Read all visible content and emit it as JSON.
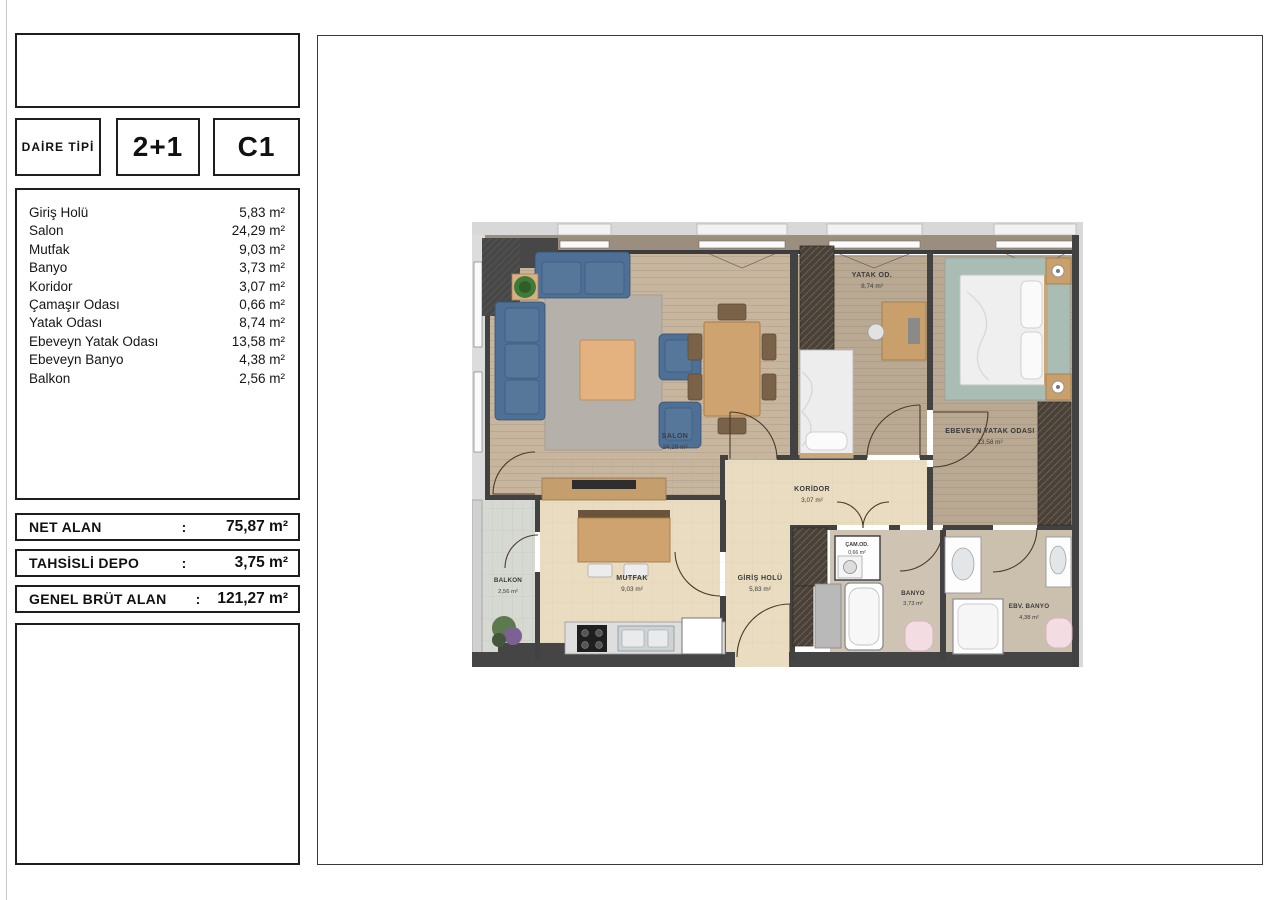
{
  "header": {
    "daire_tipi_label": "DAİRE TİPİ",
    "plan_type": "2+1",
    "unit_code": "C1"
  },
  "room_list": {
    "items": [
      {
        "name": "Giriş Holü",
        "area": "5,83 m²"
      },
      {
        "name": "Salon",
        "area": "24,29 m²"
      },
      {
        "name": "Mutfak",
        "area": "9,03 m²"
      },
      {
        "name": "Banyo",
        "area": "3,73 m²"
      },
      {
        "name": "Koridor",
        "area": "3,07 m²"
      },
      {
        "name": "Çamaşır Odası",
        "area": "0,66 m²"
      },
      {
        "name": "Yatak Odası",
        "area": "8,74 m²"
      },
      {
        "name": "Ebeveyn Yatak Odası",
        "area": "13,58 m²"
      },
      {
        "name": "Ebeveyn Banyo",
        "area": "4,38 m²"
      },
      {
        "name": "Balkon",
        "area": "2,56 m²"
      }
    ]
  },
  "summary": {
    "net_alan": {
      "label": "NET ALAN",
      "sep": ":",
      "value": "75,87 m²"
    },
    "tahsisli_depo": {
      "label": "TAHSİSLİ DEPO",
      "sep": ":",
      "value": "3,75 m²"
    },
    "genel_brut_alan": {
      "label": "GENEL BRÜT ALAN",
      "sep": ":",
      "value": "121,27 m²"
    }
  },
  "plan": {
    "rooms": [
      {
        "label": "SALON",
        "area": "24,29 m²"
      },
      {
        "label": "YATAK OD.",
        "area": "8,74 m²"
      },
      {
        "label": "EBEVEYN  YATAK ODASI",
        "area": "13,58 m²"
      },
      {
        "label": "KORİDOR",
        "area": "3,07 m²"
      },
      {
        "label": "GİRİŞ HOLÜ",
        "area": "5,83 m²"
      },
      {
        "label": "MUTFAK",
        "area": "9,03 m²"
      },
      {
        "label": "BALKON",
        "area": "2,56 m²"
      },
      {
        "label": "BANYO",
        "area": "3,73 m²"
      },
      {
        "label": "EBV. BANYO",
        "area": "4,38 m²"
      },
      {
        "label": "ÇAM.OD.",
        "area": "0,66 m²"
      }
    ]
  },
  "colors": {
    "wood_floor": "#c7b59d",
    "wood_floor_dark": "#b9a892",
    "cream_floor": "#e9dcc1",
    "bath_floor": "#cfc4b3",
    "bath_floor_dark": "#cbbfae",
    "balcony_floor": "#d6d8d2",
    "wall_dark": "#424242",
    "sofa_blue": "#4e6f96",
    "rug_gray": "#b5b1aa",
    "rug_teal": "#a9bdb5",
    "furniture_wood": "#cfa36f",
    "toilet_pink": "#f3dde2",
    "wardrobe_dark": "#4a4238"
  }
}
